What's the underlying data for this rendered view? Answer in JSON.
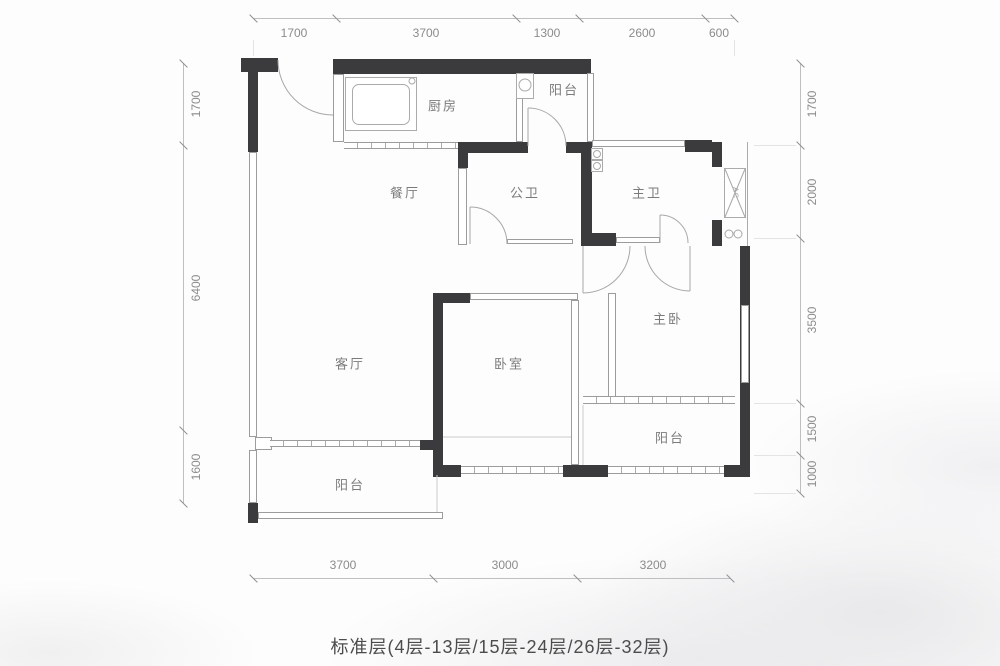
{
  "title_caption": "标准层(4层-13层/15层-24层/26层-32层)",
  "rooms": {
    "kitchen": "厨房",
    "balcony_top": "阳台",
    "dining": "餐厅",
    "public_bath": "公卫",
    "master_bath": "主卫",
    "living": "客厅",
    "bedroom": "卧室",
    "master_bedroom": "主卧",
    "balcony_right": "阳台",
    "balcony_bottom": "阳台",
    "ac_unit": "AC"
  },
  "dimensions": {
    "top": [
      "1700",
      "3700",
      "1300",
      "2600",
      "600"
    ],
    "bottom": [
      "3700",
      "3000",
      "3200"
    ],
    "left": [
      "1700",
      "6400",
      "1600"
    ],
    "right": [
      "1700",
      "2000",
      "3500",
      "1500",
      "1000"
    ]
  },
  "colors": {
    "wall": "#3b3b3d",
    "thin_line": "#9c9c9c",
    "dim_text": "#8b8b8b",
    "label_text": "#7b7b7b",
    "caption_text": "#4c4c4c"
  }
}
